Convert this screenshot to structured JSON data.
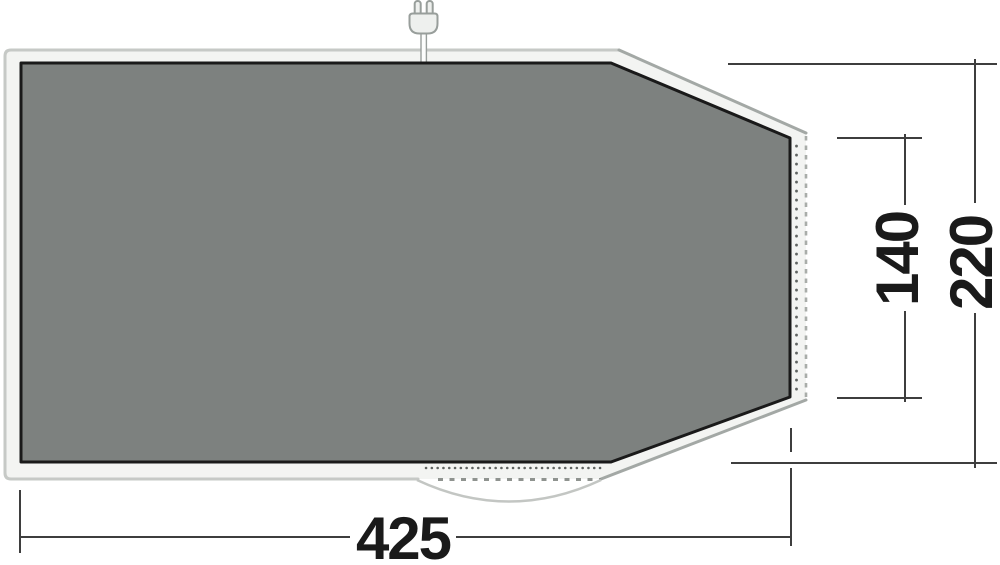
{
  "diagram": {
    "type": "tent-groundsheet-floorplan",
    "dimension_labels": {
      "width": "425",
      "depth": "220",
      "rear_width": "140"
    },
    "icons": {
      "plug": "power-plug-icon"
    },
    "colors": {
      "groundsheet_fill": "#7d817f",
      "groundsheet_border": "#1a1a1a",
      "tent_canvas_fill": "#f3f4f2",
      "tent_outline": "#c6c9c6",
      "tent_outline_shaded": "#a3a8a5",
      "dashed_edge": "#a9ada9",
      "dimension_line": "#3e3e3e",
      "dimension_text": "#1a1a1a",
      "background": "#ffffff"
    }
  }
}
